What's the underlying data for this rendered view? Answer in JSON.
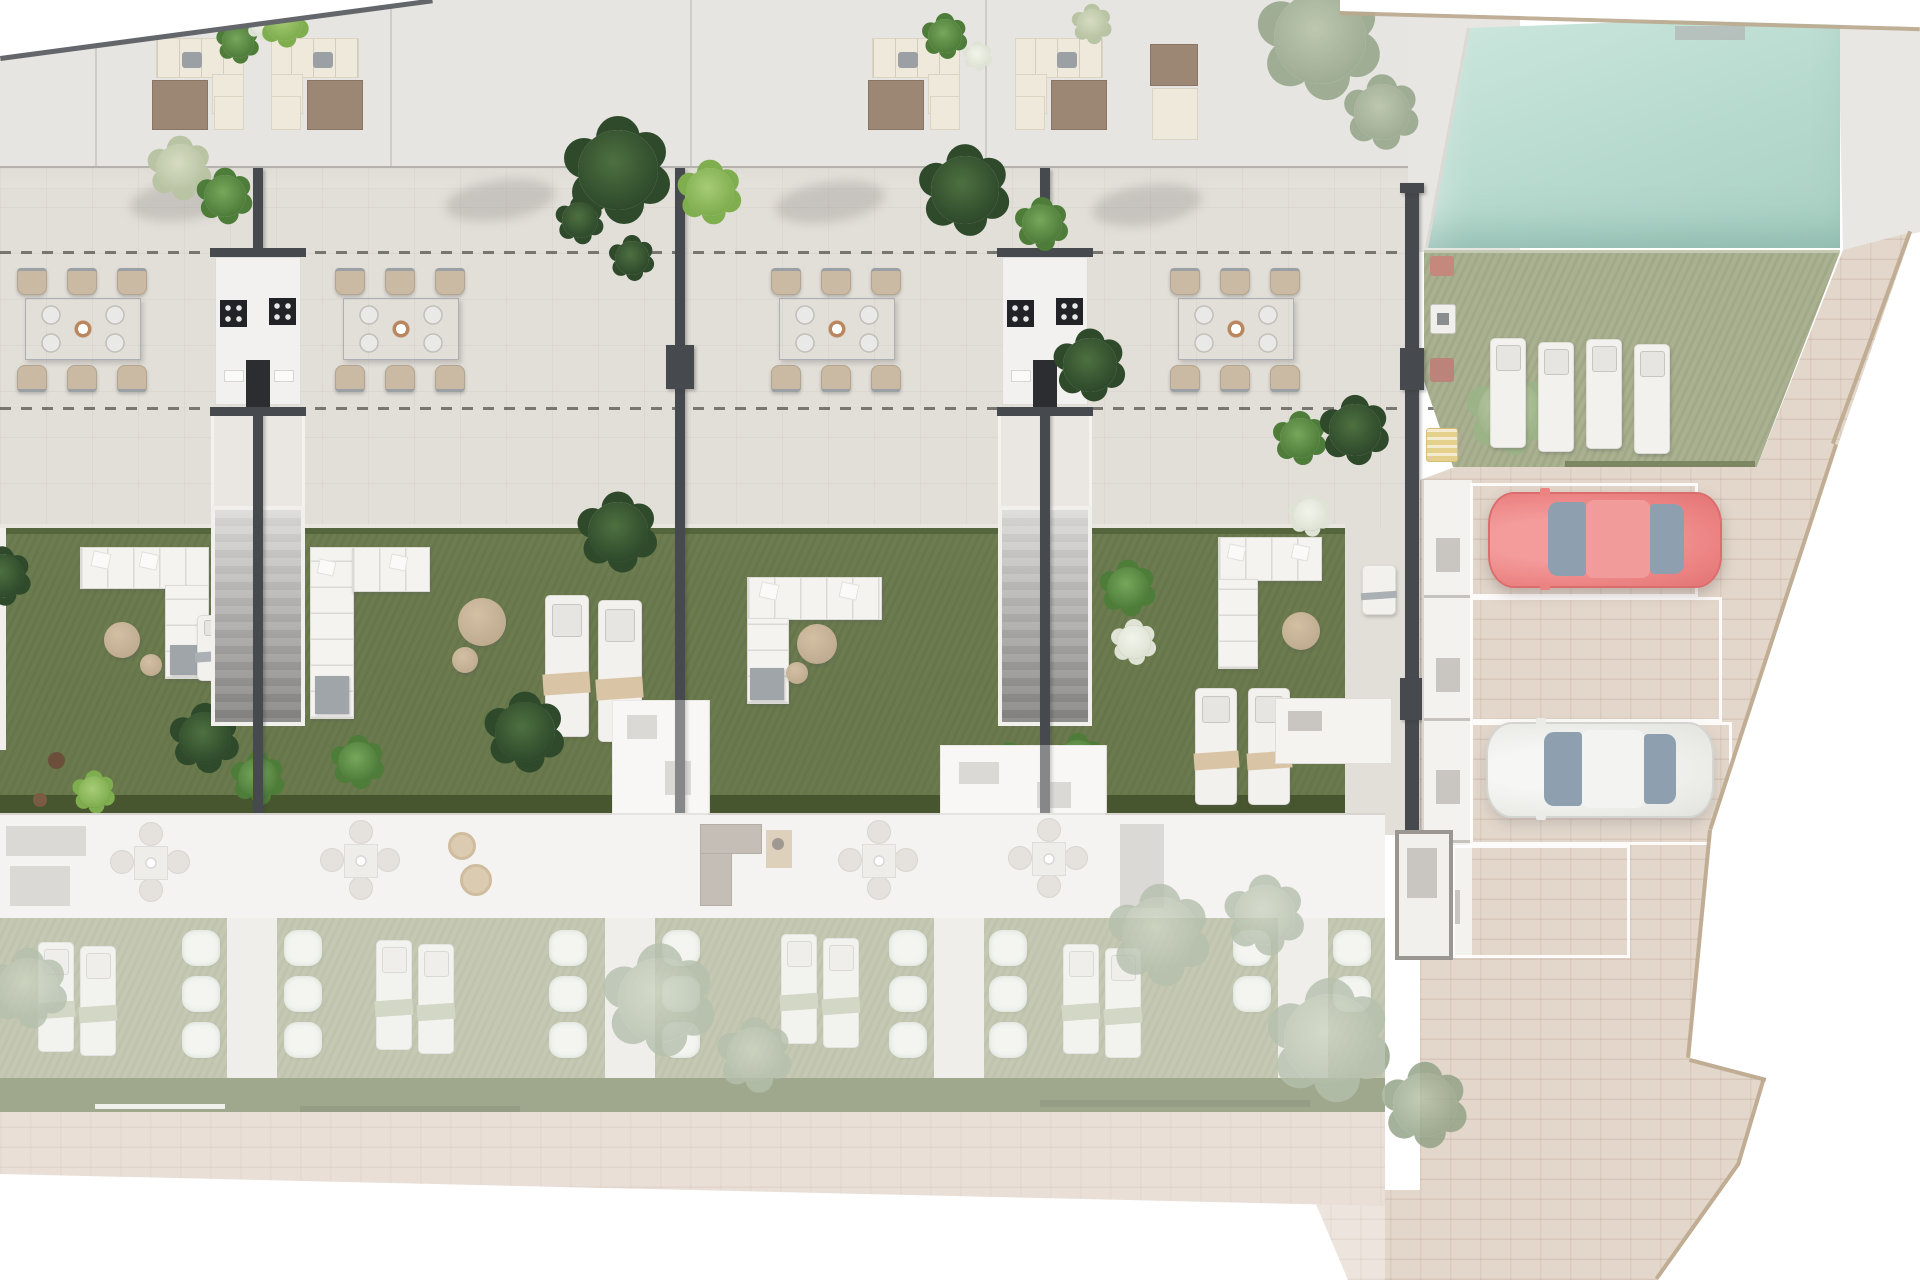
{
  "meta": {
    "title": "Townhouse development site plan – rendered top view",
    "view": "aerial 2D render, no text labels visible"
  },
  "colors": {
    "roof": "#e7e5e1",
    "terrace": "#e2ded8",
    "wall": "#46494d",
    "lawn": "#6d7d50",
    "lawn_dark": "#47562e",
    "pool": "#bcdcd1",
    "pool_lawn": "#a9b190",
    "pavers": "#e3d7cb",
    "walkway": "#decfc3",
    "bottom_lawn": "#a8ae8c",
    "car_red": "#ec8383",
    "car_white": "#ebebe8",
    "sofa": "#f4f3f0",
    "towel": "#d9c5a6",
    "boundary": "#bba88e",
    "stairs": "#a5a4a1"
  },
  "scene": {
    "top_row_units": 4,
    "roof_lounge_sets": 5,
    "outdoor_dining_sets": 4,
    "shared_kitchen_walls": 2,
    "staircases": 2,
    "garden_sofas": 4,
    "garden_sun_loungers": 6,
    "pool": {
      "position": "top-right",
      "shape": "rectangular"
    },
    "pool_lawn_loungers": 4,
    "parking_stalls": 4,
    "cars": [
      {
        "color_name": "red"
      },
      {
        "color_name": "white"
      }
    ],
    "lower_row_lounger_pairs": 4,
    "lower_row_dining_sets": 4
  }
}
